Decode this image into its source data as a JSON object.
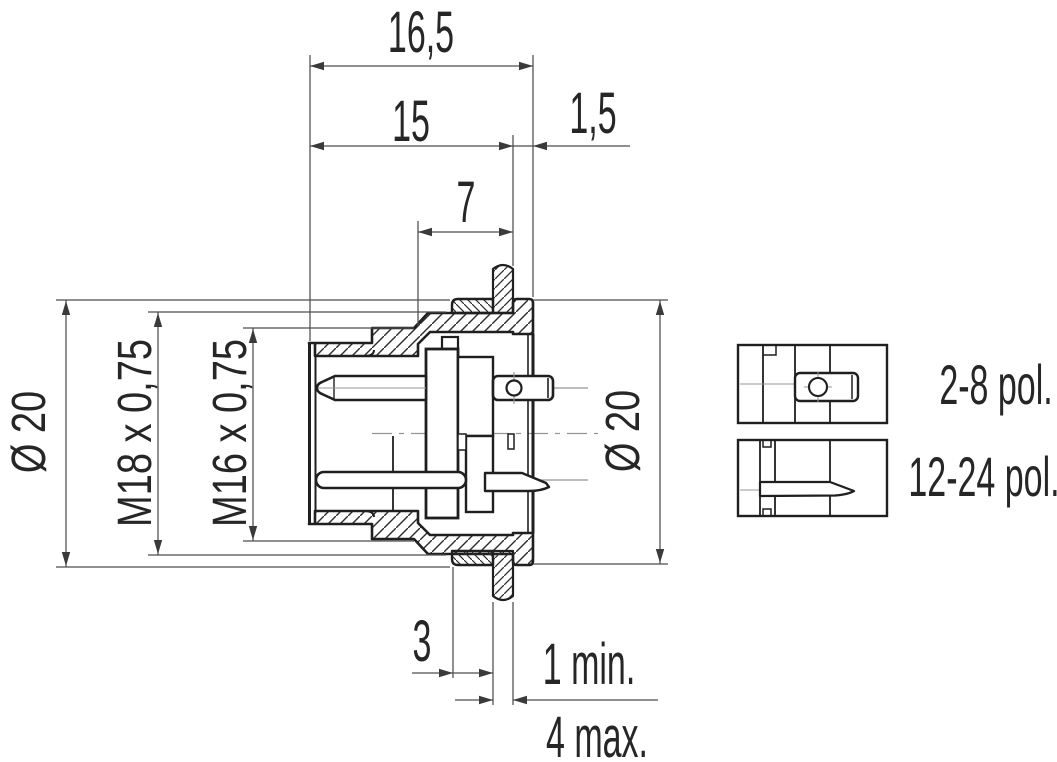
{
  "drawing": {
    "background": "#ffffff",
    "colors": {
      "outline": "#1f1f1f",
      "dim_line": "#4d4d4d",
      "centerline": "#949494",
      "text": "#262626"
    },
    "dims": {
      "overall": "16,5",
      "thread_len": "15",
      "flange_thk": "1,5",
      "front_len": "7",
      "nut_thk": "3",
      "panel_min": "1 min.",
      "panel_max": "4 max.",
      "dia_front": "Ø 20",
      "dia_flange": "Ø 20",
      "thread_outer": "M18 x 0,75",
      "thread_coupling": "M16 x 0,75"
    },
    "variants": [
      {
        "label": "2-8 pol."
      },
      {
        "label": "12-24 pol."
      }
    ]
  }
}
